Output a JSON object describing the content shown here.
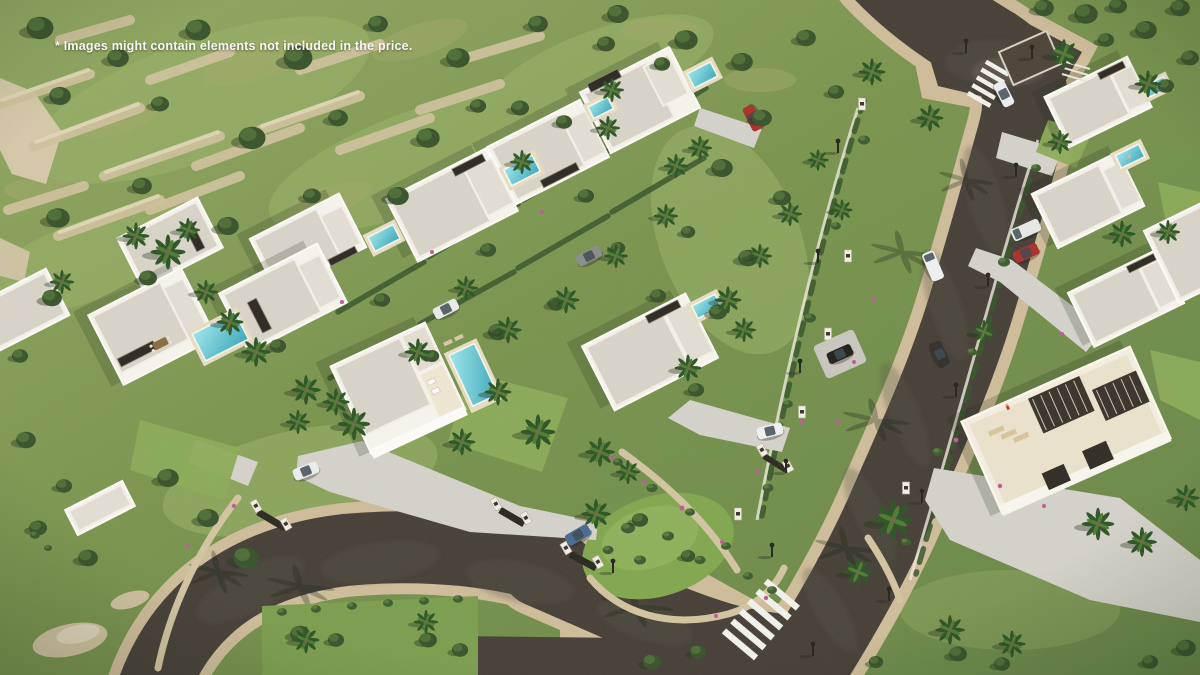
{
  "watermark": {
    "text": "* Images might contain elements not included in the price."
  },
  "image": {
    "kind": "aerial-3d-architectural-render",
    "subject": "Bird's-eye view of a modern luxury villa development with private pools, set against a green rocky hillside, crossed by a dark asphalt road with zebra crossings"
  },
  "palette": {
    "grass_base": "#75914e",
    "grass_sunlit": "#9cb36a",
    "lawn_bright": "#8cab58",
    "foliage_dark": "#3a542c",
    "palm_green": "#2f5526",
    "rock_sand": "#cfc19c",
    "road_asphalt": "#474139",
    "sidewalk_sand": "#cfbd9a",
    "roof_gravel": "#d9d4c8",
    "wall_white": "#f6f4ec",
    "accent_dark": "#2e2a24",
    "pool_turquoise": "#46b2c4",
    "pool_deck": "#e7ddc2",
    "driveway_gray": "#d4d2ca",
    "flower_pink": "#c05a9a",
    "car_red": "#a8322b",
    "car_white": "#eceef0",
    "car_dark": "#34312c",
    "car_blue": "#4a6a94"
  },
  "scene": {
    "villas_count": 14,
    "villa_style": "white flat-roof villas with gravel roof terraces, dark pergola strips and turquoise pools",
    "pools_count": 10,
    "crosswalks_count": 2,
    "roads": {
      "main": "dark asphalt road running diagonally from the top junction to the bottom crosswalk, sand-colored sidewalks on both sides",
      "loop": "curved cul-de-sac road around a green island in the lower left"
    },
    "cars": [
      {
        "color": "red",
        "location": "driveway by top villas"
      },
      {
        "color": "white",
        "location": "top zebra crossing"
      },
      {
        "color": "white-van",
        "location": "driving on main road"
      },
      {
        "color": "dark",
        "location": "driving on main road"
      },
      {
        "color": "white-van",
        "location": "parked right-side driveway"
      },
      {
        "color": "red",
        "location": "parked right-side driveway"
      },
      {
        "color": "black-suv",
        "location": "parking pad left of road"
      },
      {
        "color": "gray-suv",
        "location": "center villa lane"
      },
      {
        "color": "white-pickup",
        "location": "center villa lane"
      },
      {
        "color": "white",
        "location": "two-story villa driveway"
      },
      {
        "color": "white",
        "location": "gated driveway near road"
      },
      {
        "color": "blue",
        "location": "behind entrance gate at green island"
      }
    ],
    "people": [
      {
        "location": "pool of right-hand villa"
      },
      {
        "location": "rooftop terrace of large bottom-right villa"
      }
    ],
    "landscape": "terraced rocky hillside with scrub trees upper left, palm trees throughout, flowering hedges and stone retaining walls"
  }
}
